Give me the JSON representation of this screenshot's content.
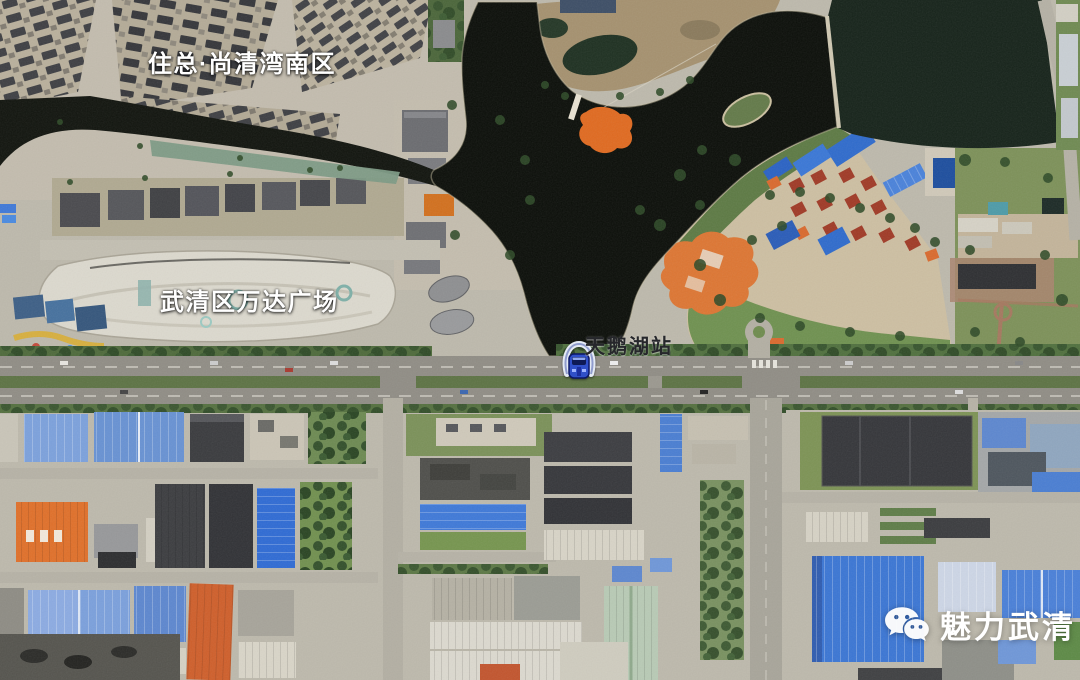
{
  "page": {
    "kind": "satellite-map-screenshot",
    "width": 1080,
    "height": 680
  },
  "map_labels": {
    "residential_area": "住总·尚清湾南区",
    "shopping_mall": "武清区万达广场",
    "metro_station": "天鹅湖站",
    "watermark": "魅力武清"
  },
  "icons": {
    "metro_station": "metro-train-icon",
    "watermark": "wechat-icon"
  },
  "colors": {
    "lake_water": "#0b0e09",
    "pond_water": "#16231a",
    "canal_teal": "#7d9a85",
    "vegetation": "#5d7a44",
    "ground": "#bdb9ac",
    "road": "#908d85",
    "warehouse_blue": "#4a7ed2",
    "warehouse_orange": "#e0702a",
    "villa_red": "#9e3a22",
    "mall_roof": "#dcd9ce",
    "place_label_text": "#ffffff",
    "station_label_text": "#26272b",
    "watermark_text": "#ffffff"
  }
}
